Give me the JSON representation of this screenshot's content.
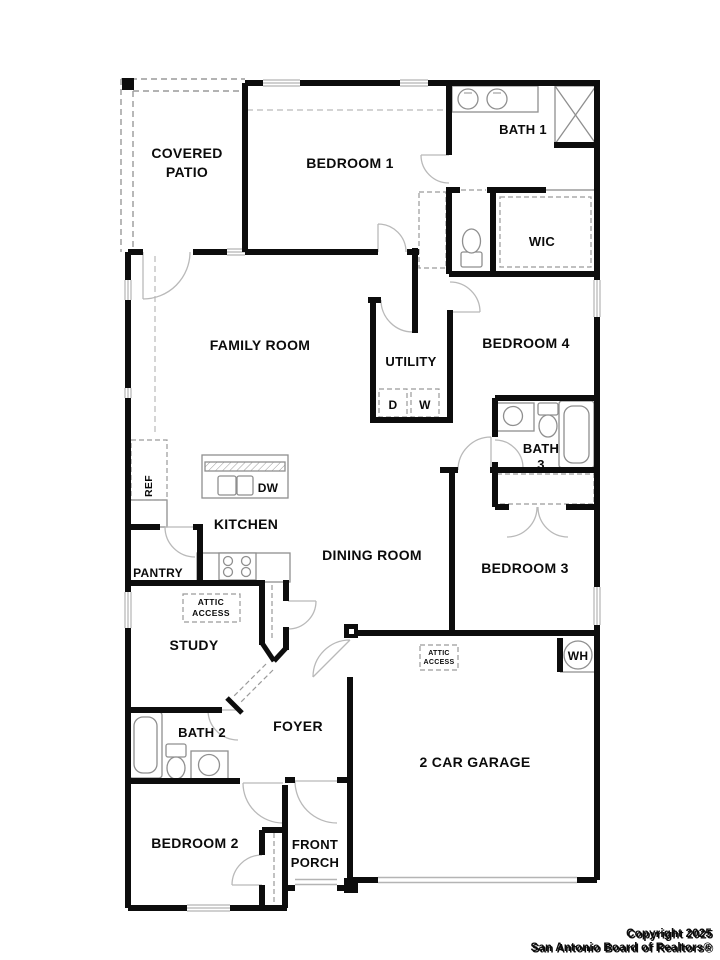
{
  "labels": {
    "covered_patio_1": "COVERED",
    "covered_patio_2": "PATIO",
    "bedroom1": "BEDROOM 1",
    "bath1": "BATH 1",
    "wic": "WIC",
    "family_room": "FAMILY ROOM",
    "utility": "UTILITY",
    "bedroom4": "BEDROOM 4",
    "bath3_line1": "BATH",
    "bath3_line2": "3",
    "kitchen": "KITCHEN",
    "dining_room": "DINING ROOM",
    "pantry": "PANTRY",
    "study": "STUDY",
    "attic_access_study_1": "ATTIC",
    "attic_access_study_2": "ACCESS",
    "bedroom3": "BEDROOM 3",
    "foyer": "FOYER",
    "bath2": "BATH 2",
    "attic_access_garage_1": "ATTIC",
    "attic_access_garage_2": "ACCESS",
    "garage": "2 CAR GARAGE",
    "bedroom2": "BEDROOM 2",
    "front_porch_1": "FRONT",
    "front_porch_2": "PORCH"
  },
  "appliances": {
    "refrigerator": "REF",
    "dishwasher": "DW",
    "dryer": "D",
    "washer": "W",
    "water_heater": "WH"
  },
  "footer": {
    "copyright_line1": "Copyright 2025",
    "copyright_line2": "San Antonio Board of Realtors®"
  },
  "colors": {
    "wall": "#0d0d0d",
    "fixture": "#8f8f8f",
    "dashed": "#9a9a9a",
    "window": "#b4b4b4",
    "door_arc": "#b9b9b9",
    "copyright_shadow": "#8a8a8a",
    "copyright_text": "#ffffff"
  }
}
